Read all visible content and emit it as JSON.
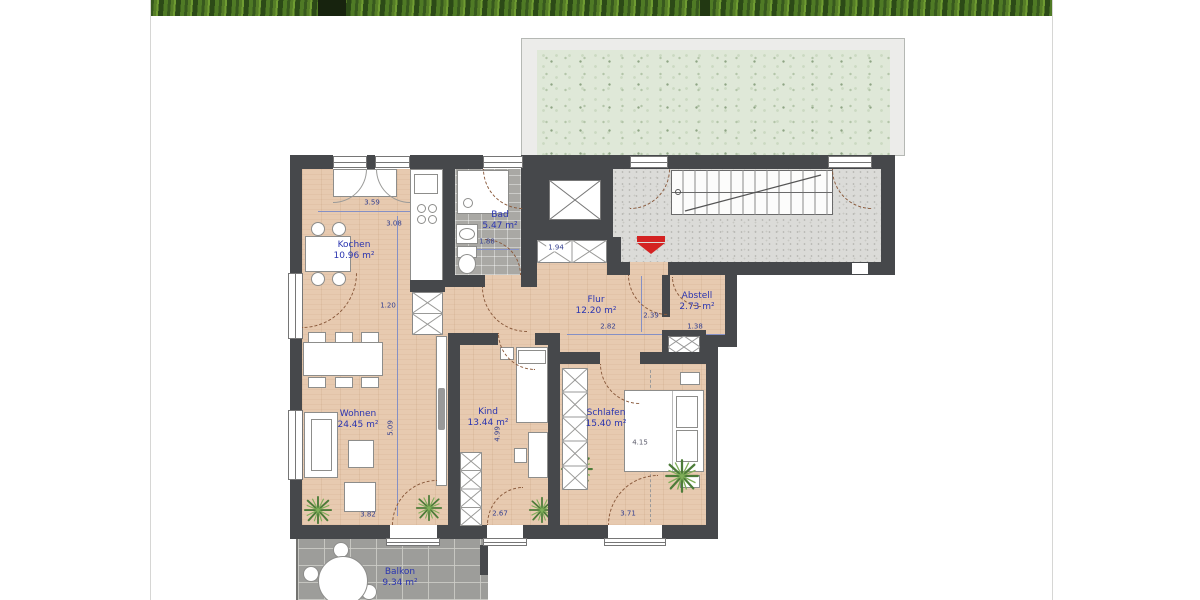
{
  "floorplan": {
    "rooms": [
      {
        "name": "Kochen",
        "area": "10.96 m²"
      },
      {
        "name": "Bad",
        "area": "5.47 m²"
      },
      {
        "name": "Flur",
        "area": "12.20 m²"
      },
      {
        "name": "Abstell",
        "area": "2.73 m²"
      },
      {
        "name": "Wohnen",
        "area": "24.45 m²"
      },
      {
        "name": "Kind",
        "area": "13.44 m²"
      },
      {
        "name": "Schlafen",
        "area": "15.40 m²"
      },
      {
        "name": "Balkon",
        "area": "9.34 m²"
      }
    ],
    "dimensions": {
      "d359": "3.59",
      "d308": "3.08",
      "d188": "1.88",
      "d194": "1.94",
      "d120": "1.20",
      "d282": "2.82",
      "d239": "2.39",
      "d138": "1.38",
      "d509": "5.09",
      "d499": "4.99",
      "d415": "4.15",
      "d382": "3.82",
      "d267": "2.67",
      "d371": "3.71"
    },
    "icons": {
      "entrance_arrow": "red-arrow-down",
      "elevator": "crossed-box",
      "stairs": "treads-with-run-line",
      "shaft": "crossed-diamond-box",
      "plant": "green-starburst"
    },
    "colors": {
      "room_label": "#2b35b0",
      "dimension_text": "#333f8f",
      "wall": "#46484b",
      "wood_floor": "#e7cab0",
      "bath_tile": "#a9a8a4",
      "stair_floor": "#dbdbd8",
      "green_roof": "#dfe8d8",
      "balcony": "#9d9d9a",
      "entrance_arrow": "#d42222",
      "door_swing": "#8a5a3c",
      "foliage_banner": "#3a5c20"
    }
  }
}
